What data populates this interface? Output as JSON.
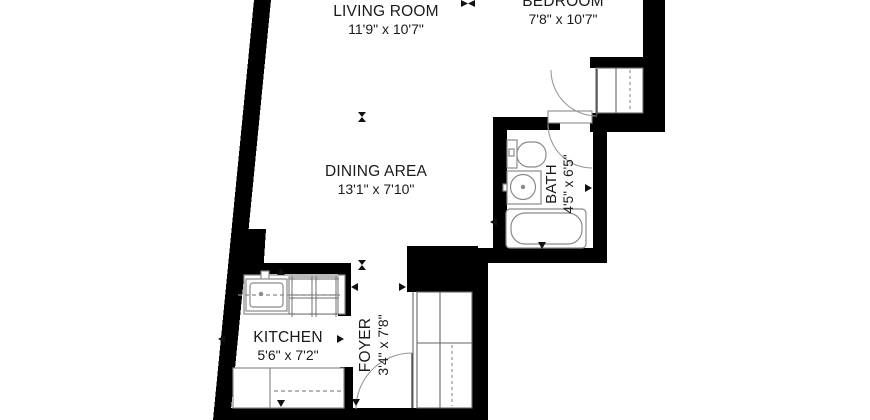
{
  "title": "Apartment floor plan",
  "colors": {
    "wall": "#000000",
    "fixture_line": "#8a8a8a",
    "door_arc": "#9a9a9a",
    "text": "#1a1a1a",
    "background": "#ffffff"
  },
  "rooms": {
    "living_room": {
      "label": "LIVING ROOM",
      "dimensions": "11'9\" x 10'7\""
    },
    "bedroom": {
      "label": "BEDROOM",
      "dimensions": "7'8\" x 10'7\""
    },
    "dining_area": {
      "label": "DINING AREA",
      "dimensions": "13'1\" x 7'10\""
    },
    "bath": {
      "label": "BATH",
      "dimensions": "4'5\" x 6'5\""
    },
    "kitchen": {
      "label": "KITCHEN",
      "dimensions": "5'6\" x 7'2\""
    },
    "foyer": {
      "label": "FOYER",
      "dimensions": "3'4\" x 7'8\""
    }
  }
}
